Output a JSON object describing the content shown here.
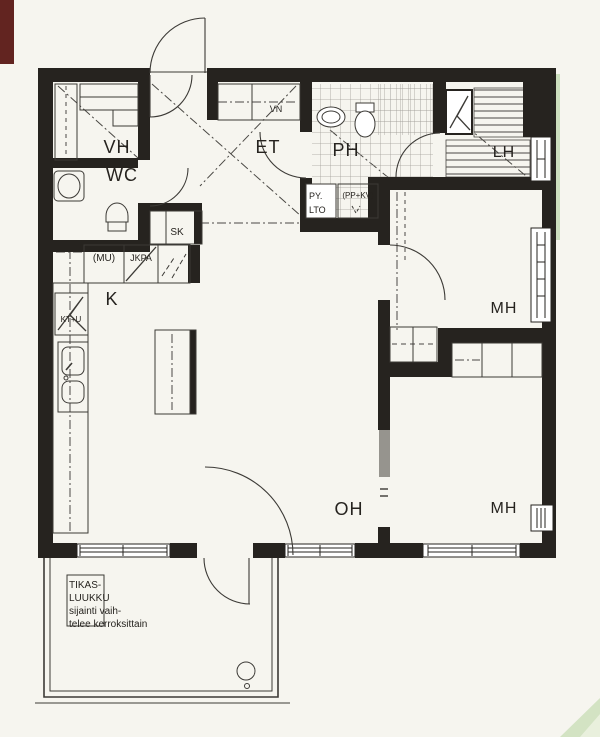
{
  "labels": {
    "vh": "VH",
    "wc": "WC",
    "et": "ET",
    "ph": "PH",
    "lh": "LH",
    "k": "K",
    "oh": "OH",
    "mh_upper": "MH",
    "mh_lower": "MH"
  },
  "fixtures": {
    "vn": "VN",
    "sk": "SK",
    "mu": "(MU)",
    "jkpa": "JKPA",
    "kt_u": "KT+U",
    "py": "PY.",
    "lto": "LTO",
    "pp_kv": "(PP+KV)"
  },
  "balcony_note": {
    "line1": "TIKAS-",
    "line2": "LUUKKU",
    "line3": "sijainti vaih-",
    "line4": "telee kerroksittain"
  },
  "colors": {
    "wall": "#26231f",
    "line": "#3c3a36",
    "grid": "#a09e98",
    "paper": "#f6f5ef",
    "scan_red": "#622420",
    "scan_green": "#ccdfbe"
  }
}
